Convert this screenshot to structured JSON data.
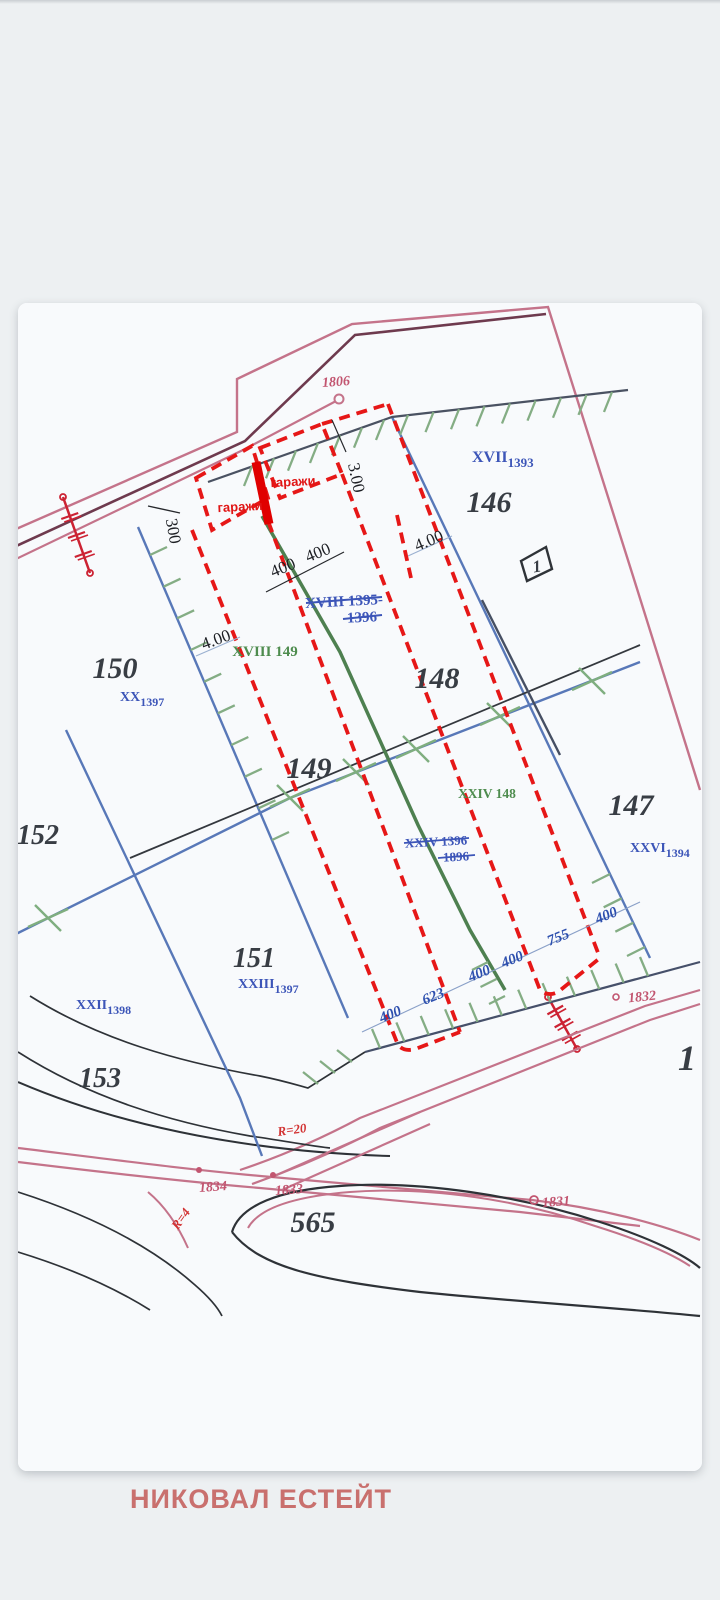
{
  "brand": {
    "name": "НИКОВАЛ ЕСТЕЙТ"
  },
  "map": {
    "parcels": {
      "n146": "146",
      "n147": "147",
      "n148": "148",
      "n149": "149",
      "n150": "150",
      "n151": "151",
      "n152": "152",
      "n153": "153",
      "n565": "565",
      "n1_clipped": "1"
    },
    "roman": {
      "xvii": "XVII",
      "xvii_sub": "1393",
      "xx": "XX",
      "xx_sub": "1397",
      "xxvi": "XXVI",
      "xxvi_sub": "1394",
      "xxiii": "XXIII",
      "xxiii_sub": "1397",
      "xxii": "XXII",
      "xxii_sub": "1398",
      "xviii_green": "XVIII 149",
      "xxiv_green": "XXIV 148",
      "xviii_struck_a": "XVIII 1395-",
      "xviii_struck_b": "1396",
      "xxiv_struck_a": "XXIV 1396",
      "xxiv_struck_b": "1896"
    },
    "garages": {
      "label_left": "гаражи",
      "label_right": "гаражи"
    },
    "dims": {
      "v300": "300",
      "v3_00": "3.00",
      "v4_00_left": "4.00",
      "v4_00_right": "4.00",
      "v400_a": "400",
      "v400_b": "400"
    },
    "blue_dims": [
      "400",
      "623",
      "400",
      "400",
      "755",
      "400"
    ],
    "points": {
      "p1806": "1806",
      "p1831": "1831",
      "p1832": "1832",
      "p1833": "1833",
      "p1834": "1834"
    },
    "radii": {
      "r20": "R=20",
      "r4": "R=4"
    },
    "building_no": "1"
  },
  "colors": {
    "page_bg": "#edf0f2",
    "paper": "#f8fafc",
    "accent_red_dashed": "#e61717",
    "highlight_red": "#e00000",
    "boundary_blue": "#5878b8",
    "hatch_green": "#84ad84",
    "axis_green": "#4e8050",
    "road_pink": "#c4738a",
    "road_maroon": "#6e3a4e",
    "label_blue": "#3c55b8",
    "label_green": "#4e8c4e",
    "label_pink": "#c25570",
    "brand_text": "#c9706e"
  }
}
